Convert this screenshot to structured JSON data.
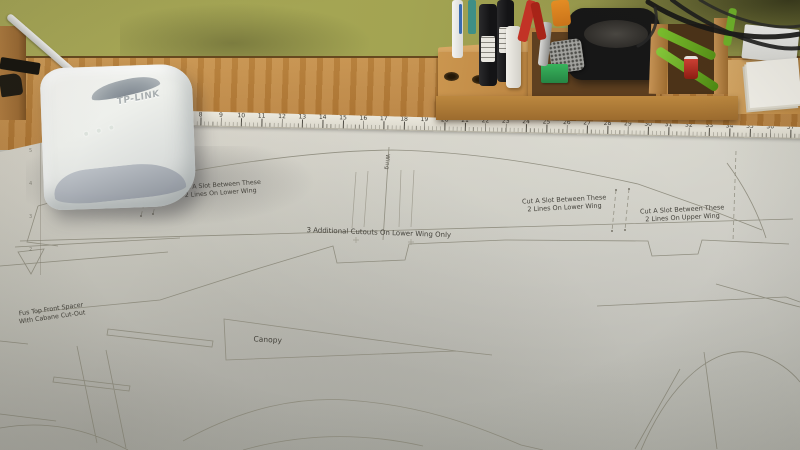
{
  "router": {
    "brand": "TP-LINK"
  },
  "ruler": {
    "numbers": [
      8,
      9,
      10,
      11,
      12,
      13,
      14,
      15,
      16,
      17,
      18,
      19,
      20,
      21,
      22,
      23,
      24,
      25,
      26,
      27,
      28,
      29,
      30,
      31,
      32,
      33,
      34,
      35,
      36,
      37
    ],
    "left_numbers": [
      5,
      4,
      3,
      2
    ]
  },
  "annotations": {
    "upper_left": {
      "line1": "Cut A Slot Between These",
      "line2": "2 Lines On Upper Wing"
    },
    "lower_left": {
      "line1": "Cut A Slot Between These",
      "line2": "2 Lines On Lower Wing"
    },
    "lower_right": {
      "line1": "Cut A Slot Between These",
      "line2": "2 Lines On Lower Wing"
    },
    "upper_right": {
      "line1": "Cut A Slot Between These",
      "line2": "2 Lines On Upper Wing"
    },
    "cutouts": {
      "line1": "3 Additional Cutouts On Lower Wing Only"
    },
    "fus_spacer": {
      "line1": "Fus Top Front Spacer",
      "line2": "With Cabane Cut-Out"
    },
    "canopy": {
      "line1": "Canopy"
    },
    "wing_vertical": {
      "line1": "Wing"
    }
  },
  "colors": {
    "wall": "#a3a452",
    "desk_wood": "#b57c38",
    "caddy_wood": "#c08a4c",
    "paper": "#d2cfc7",
    "plan_line": "#8b887a",
    "annotation_text": "#45433c",
    "router_body": "#ebece8",
    "marker_black": "#1c1c1e",
    "tool_green": "#7cc12e",
    "tool_red": "#c23326",
    "box_green": "#2f9e4e"
  }
}
